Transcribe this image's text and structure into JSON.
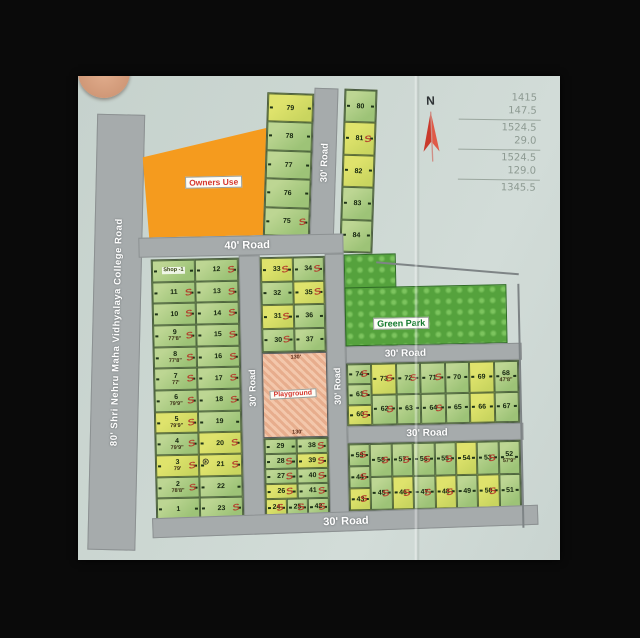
{
  "map": {
    "roads": {
      "college_road": "80' Shri Nehru Maha Vidhyalaya College Road",
      "road_40": "40' Road",
      "road_30": "30' Road"
    },
    "areas": {
      "owners_use": "Owners Use",
      "green_park": "Green Park",
      "playground": "Playground",
      "playground_dim": "130'"
    },
    "north_label": "N",
    "blocks": {
      "left": {
        "columns": [
          [
            "Shop -1",
            "11",
            "10",
            "9",
            "8",
            "7",
            "6",
            "5",
            "4",
            "3",
            "2",
            "1"
          ],
          [
            "12",
            "13",
            "14",
            "15",
            "16",
            "17",
            "18",
            "19",
            "20",
            "21",
            "22",
            "23"
          ]
        ]
      },
      "top_west_strip": {
        "columns": [
          [
            "79",
            "78",
            "77",
            "76",
            "75"
          ]
        ]
      },
      "top_east_strip": {
        "columns": [
          [
            "80",
            "81",
            "82",
            "83",
            "84"
          ]
        ]
      },
      "mid_upper": {
        "columns": [
          [
            "33",
            "32",
            "31",
            "30"
          ],
          [
            "34",
            "35",
            "36",
            "37"
          ]
        ]
      },
      "mid_lower": {
        "columns": [
          [
            "29",
            "28",
            "27",
            "26"
          ],
          [
            "38",
            "39",
            "40",
            "41"
          ]
        ],
        "bottom_row": [
          "24",
          "25",
          "42"
        ]
      },
      "right_upper": {
        "columns": [
          [
            "74",
            "61",
            "60"
          ],
          [
            "73",
            "62"
          ],
          [
            "72",
            "63"
          ],
          [
            "71",
            "64"
          ],
          [
            "70",
            "65"
          ],
          [
            "69",
            "66"
          ],
          [
            "68",
            "67"
          ]
        ]
      },
      "right_lower": {
        "columns": [
          [
            "59",
            "44",
            "43"
          ],
          [
            "58",
            "45"
          ],
          [
            "57",
            "46"
          ],
          [
            "56",
            "47"
          ],
          [
            "55",
            "48"
          ],
          [
            "54",
            "49"
          ],
          [
            "53",
            "50"
          ],
          [
            "52",
            "51"
          ]
        ]
      }
    },
    "marked_plots": [
      "11",
      "10",
      "9",
      "8",
      "7",
      "6",
      "5",
      "4",
      "3",
      "2",
      "13",
      "14",
      "15",
      "16",
      "17",
      "18",
      "20",
      "21",
      "23",
      "12",
      "33",
      "34",
      "35",
      "31",
      "30",
      "28",
      "27",
      "26",
      "24",
      "25",
      "39",
      "40",
      "41",
      "42",
      "38",
      "74",
      "73",
      "72",
      "71",
      "61",
      "60",
      "81",
      "75",
      "58",
      "57",
      "56",
      "55",
      "45",
      "46",
      "47",
      "48",
      "59",
      "44",
      "43",
      "62",
      "64",
      "53",
      "50"
    ],
    "yellow_plots": [
      "33",
      "31",
      "26",
      "39",
      "24",
      "5",
      "3",
      "79",
      "81",
      "73",
      "69",
      "66",
      "54",
      "48",
      "60",
      "43",
      "21",
      "20",
      "50",
      "82",
      "35",
      "46"
    ],
    "plot_dims": {
      "9": "77'8\"",
      "8": "77'8\"",
      "7": "77'",
      "6": "79'9\"",
      "5": "79'9\"",
      "4": "79'9\"",
      "3": "79'",
      "2": "78'8\"",
      "52": "57'9\"",
      "68": "47'8\""
    },
    "well_plot": "21"
  },
  "handwritten_calc": {
    "groups": [
      [
        "1415",
        "147.5"
      ],
      [
        "1524.5",
        "29.0"
      ],
      [
        "1524.5",
        "129.0"
      ],
      [
        "1345.5"
      ]
    ]
  },
  "colors": {
    "paper": "#ccd7d2",
    "road_gray": "#a6abac",
    "plot_green": "#aecb82",
    "plot_yellow": "#dfe36c",
    "owners_orange": "#f59b1e",
    "park_green": "#55a23d",
    "playground_pink": "#f3c7ab",
    "sold_mark_red": "#b5372a",
    "label_red": "#d5372e",
    "label_green": "#147a2e",
    "background_black": "#0a0a0a"
  }
}
